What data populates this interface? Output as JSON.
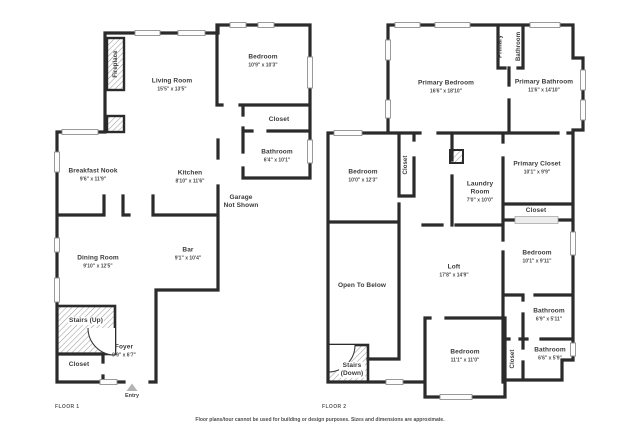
{
  "page": {
    "background": "#ffffff",
    "wall_color": "#2b2b2b"
  },
  "footer": {
    "disclaimer": "Floor plans/tour cannot be used for building or design purposes. Sizes and dimensions are approximate."
  },
  "floor1": {
    "caption": "FLOOR 1",
    "entry_label": "Entry",
    "rooms": {
      "fireplace": {
        "name": "Fireplace"
      },
      "living_room": {
        "name": "Living Room",
        "dims": "15'5\" x 13'5\""
      },
      "bedroom": {
        "name": "Bedroom",
        "dims": "10'9\" x 10'3\""
      },
      "closet": {
        "name": "Closet"
      },
      "bathroom": {
        "name": "Bathroom",
        "dims": "6'4\" x 10'1\""
      },
      "breakfast_nook": {
        "name": "Breakfast Nook",
        "dims": "9'6\" x 11'9\""
      },
      "kitchen": {
        "name": "Kitchen",
        "dims": "8'10\" x 11'6\""
      },
      "garage": {
        "name": "Garage",
        "line2": "Not Shown"
      },
      "dining_room": {
        "name": "Dining Room",
        "dims": "9'10\" x 12'5\""
      },
      "bar": {
        "name": "Bar",
        "dims": "9'1\" x 10'4\""
      },
      "stairs_up": {
        "name": "Stairs (Up)"
      },
      "foyer": {
        "name": "Foyer",
        "dims": "9'9\" x 6'7\""
      },
      "closet_entry": {
        "name": "Closet"
      }
    }
  },
  "floor2": {
    "caption": "FLOOR 2",
    "rooms": {
      "primary_bedroom": {
        "name": "Primary Bedroom",
        "dims": "16'6\" x 18'10\""
      },
      "primary_bathroom_wc": {
        "name": "Primary Bathroom"
      },
      "primary_bathroom": {
        "name": "Primary Bathroom",
        "dims": "11'6\" x 14'10\""
      },
      "bedroom_left": {
        "name": "Bedroom",
        "dims": "10'0\" x 12'3\""
      },
      "closet_mid": {
        "name": "Closet"
      },
      "laundry": {
        "name": "Laundry Room",
        "dims": "7'0\" x 10'0\""
      },
      "primary_closet": {
        "name": "Primary Closet",
        "dims": "10'1\" x 9'9\""
      },
      "closet_right": {
        "name": "Closet"
      },
      "bedroom_right": {
        "name": "Bedroom",
        "dims": "10'1\" x 9'11\""
      },
      "bathroom_upper": {
        "name": "Bathroom",
        "dims": "6'9\" x 5'11\""
      },
      "closet_lower": {
        "name": "Closet"
      },
      "bathroom_lower": {
        "name": "Bathroom",
        "dims": "6'6\" x 5'9\""
      },
      "loft": {
        "name": "Loft",
        "dims": "17'8\" x 14'9\""
      },
      "open_to_below": {
        "name": "Open To Below"
      },
      "bedroom_bottom": {
        "name": "Bedroom",
        "dims": "11'1\" x 11'0\""
      },
      "stairs_down": {
        "name": "Stairs (Down)"
      }
    }
  }
}
